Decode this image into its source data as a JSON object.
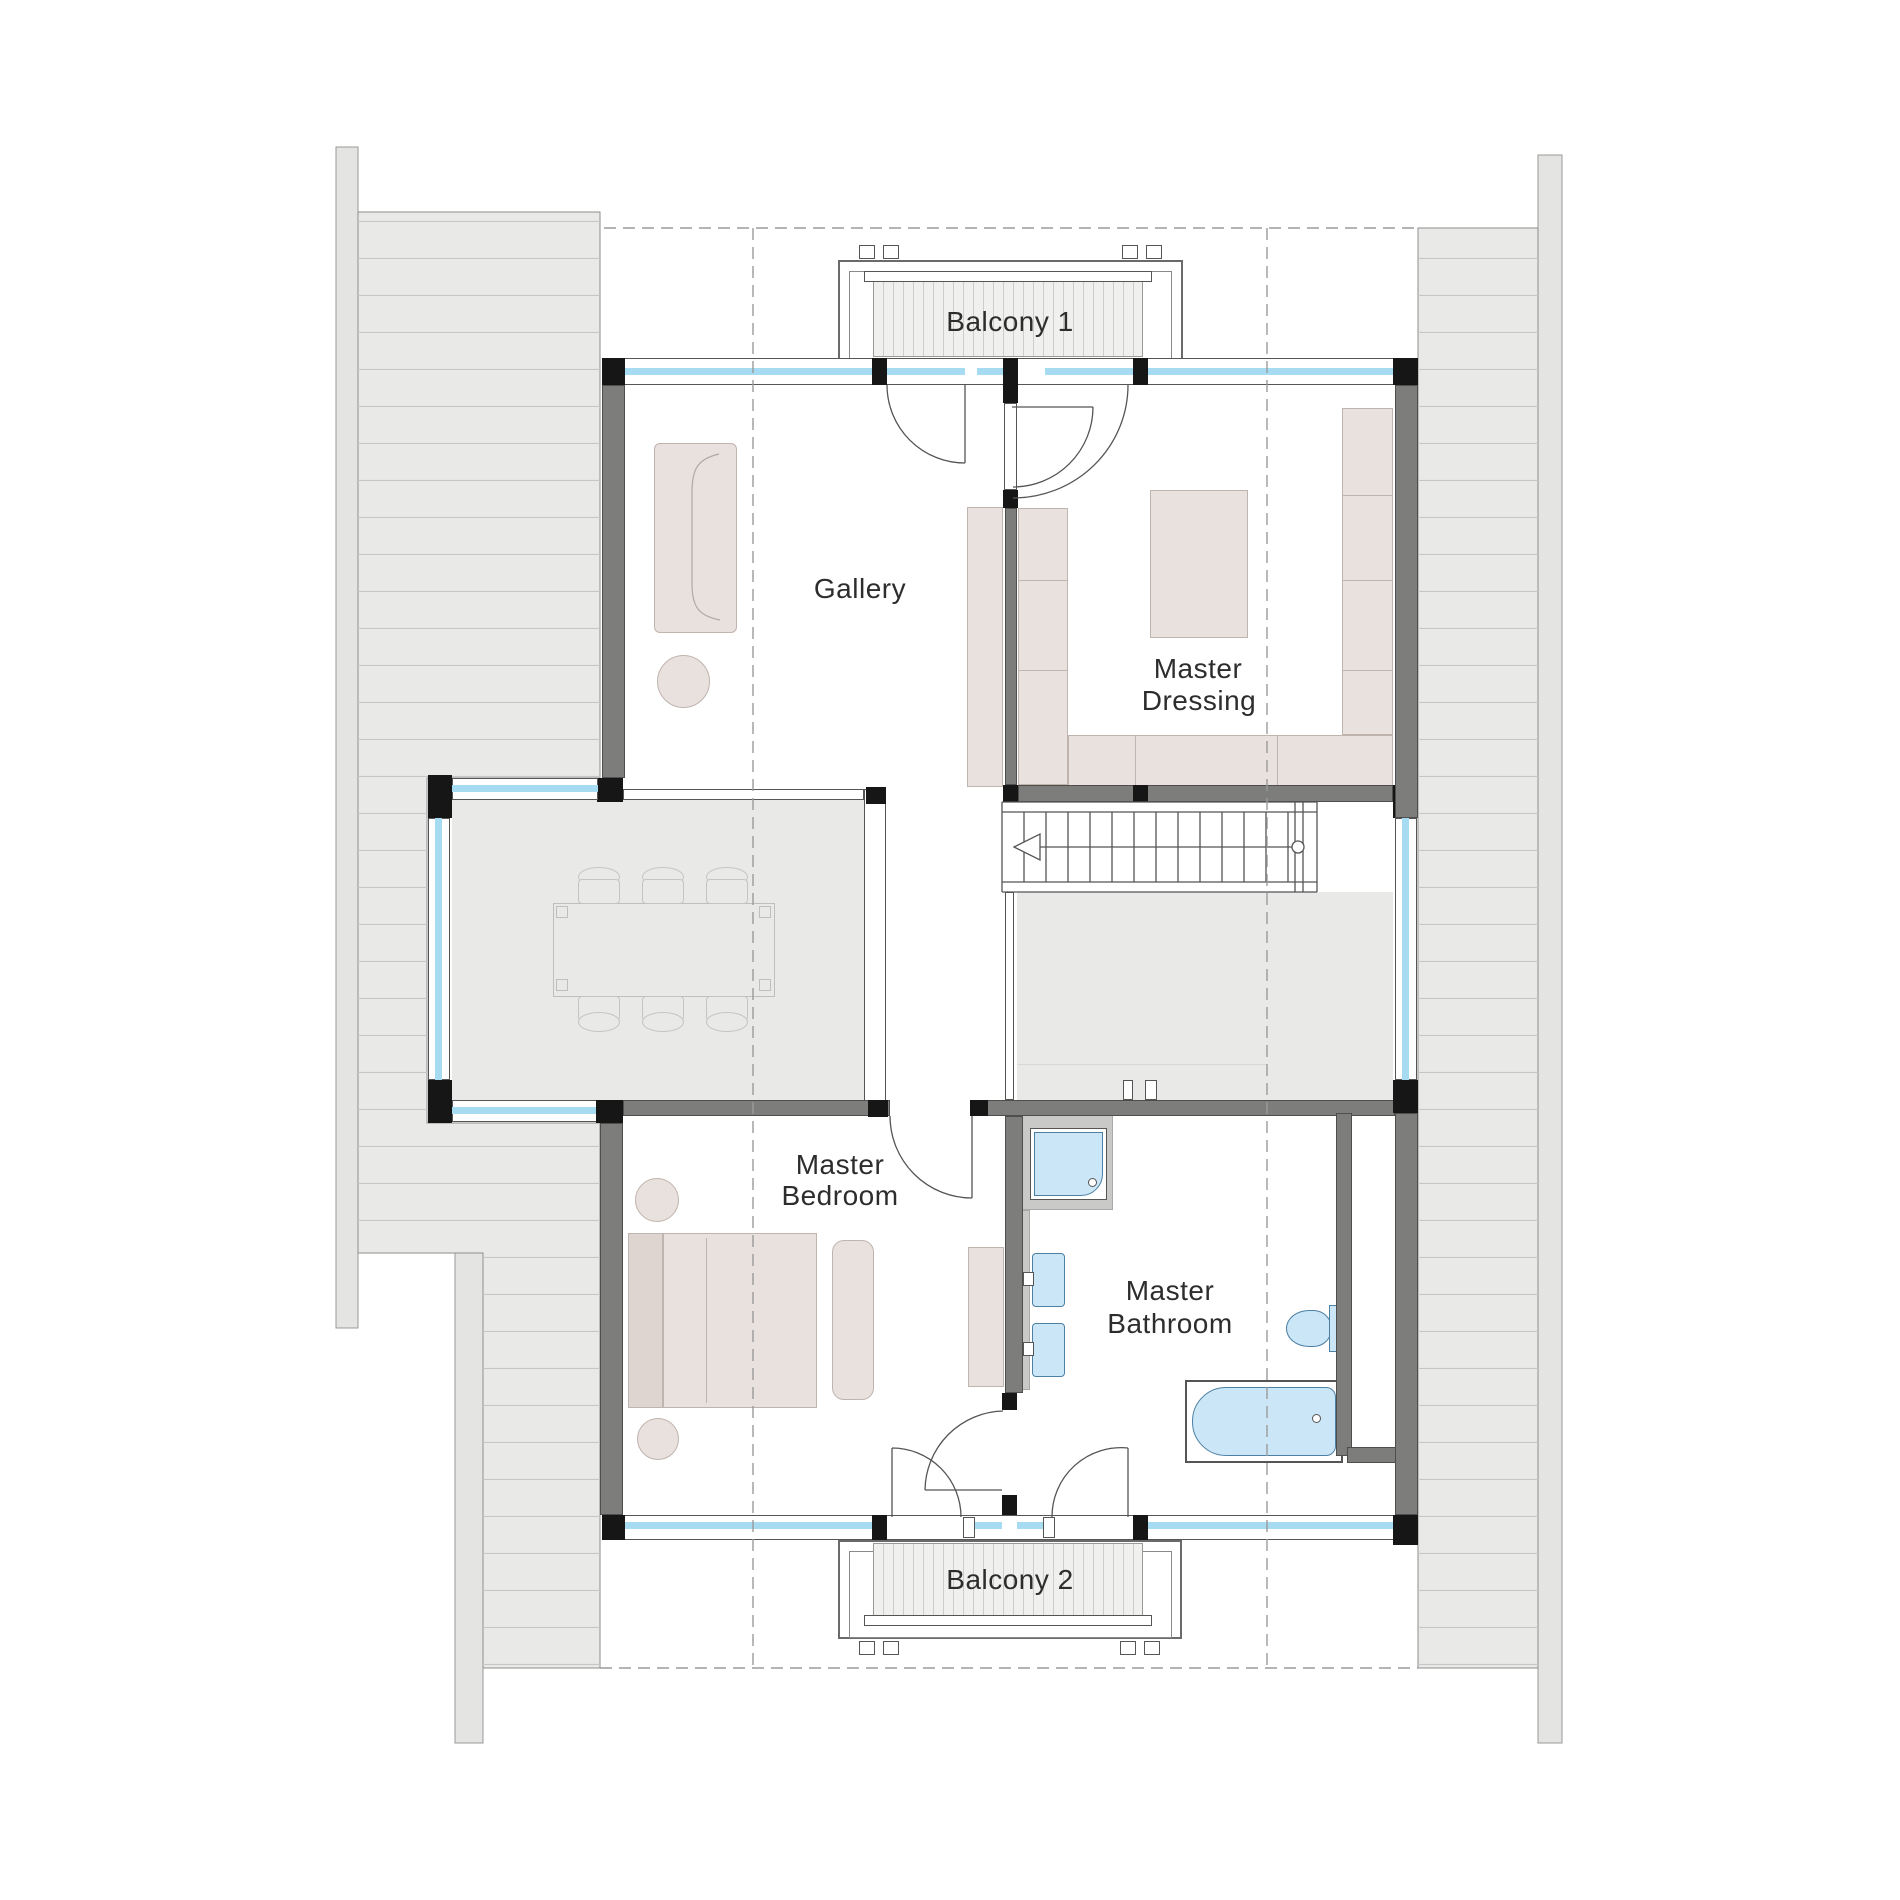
{
  "rooms": [
    {
      "id": "balcony-1",
      "label": "Balcony 1"
    },
    {
      "id": "gallery",
      "label": "Gallery"
    },
    {
      "id": "master-dressing",
      "label_line1": "Master",
      "label_line2": "Dressing"
    },
    {
      "id": "master-bedroom",
      "label_line1": "Master",
      "label_line2": "Bedroom"
    },
    {
      "id": "master-bathroom",
      "label_line1": "Master",
      "label_line2": "Bathroom"
    },
    {
      "id": "balcony-2",
      "label": "Balcony 2"
    }
  ],
  "colors": {
    "wall": "#7d7d7b",
    "wallEdge": "#4e4e4c",
    "black": "#161616",
    "glass": "#a6dbf2",
    "floorGray": "#e9e9e8",
    "furn": "#e8e1dd",
    "furnEdge": "#c0b4ae",
    "fixture": "#cbe6f7",
    "fixtureEdge": "#4e80a4",
    "roofFill": "#e9e9e7",
    "roofLine": "#c6c6c4",
    "roofEdge": "#8e8e8c",
    "stripFill": "#e4e4e2",
    "lineDark": "#555555",
    "dashed": "#9b9b9b",
    "text": "#2d2d2d"
  }
}
